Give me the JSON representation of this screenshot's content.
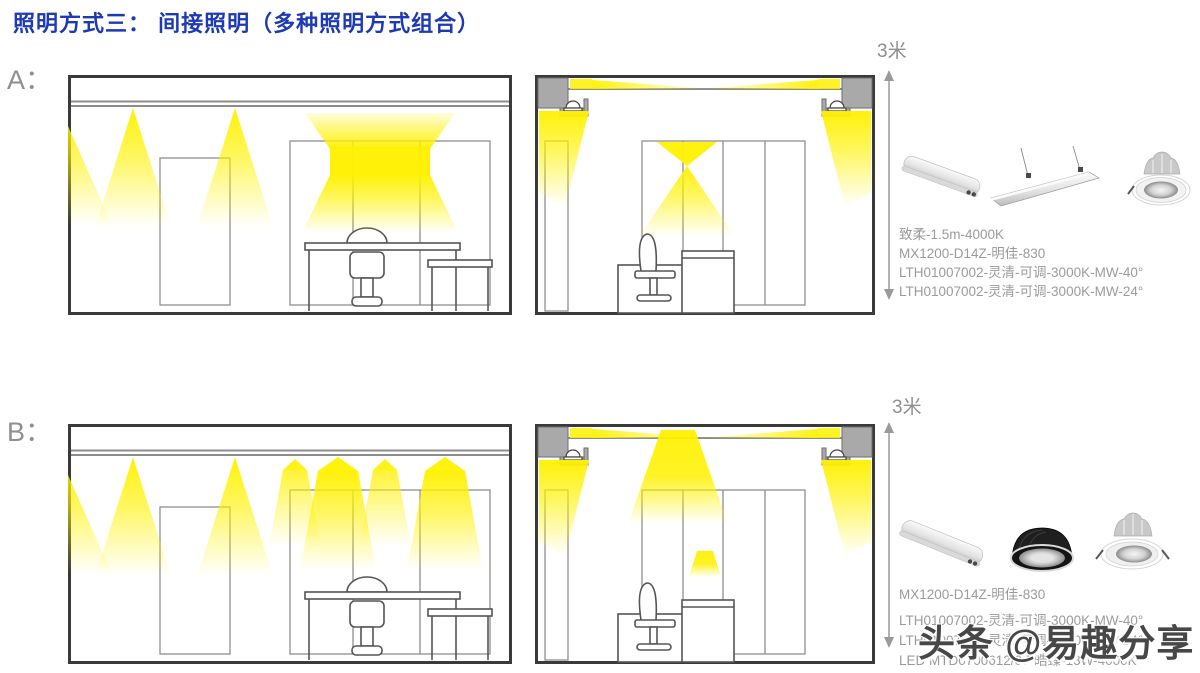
{
  "title": "照明方式三： 间接照明（多种照明方式组合）",
  "watermark": "头条 @易趣分享",
  "colors": {
    "title_blue": "#1D39B5",
    "light_yellow": "#FFF100",
    "ceiling_gray": "#A9A9A9",
    "text_gray": "#9B9B9B"
  },
  "sections": [
    {
      "id": "A",
      "label": "A：",
      "height_label": "3米",
      "product_images": [
        {
          "name": "linear-batten-tube-light"
        },
        {
          "name": "suspended-linear-panel-light"
        },
        {
          "name": "recessed-downlight-white"
        }
      ],
      "product_lines": [
        "致柔-1.5m-4000K",
        "MX1200-D14Z-明佳-830",
        "LTH01007002-灵清-可调-3000K-MW-40°",
        "LTH01007002-灵清-可调-3000K-MW-24°"
      ]
    },
    {
      "id": "B",
      "label": "B：",
      "height_label": "3米",
      "product_images": [
        {
          "name": "linear-batten-tube-light"
        },
        {
          "name": "recessed-downlight-black"
        },
        {
          "name": "recessed-downlight-white"
        }
      ],
      "product_lines": [
        "MX1200-D14Z-明佳-830",
        "LTH01007002-灵清-可调-3000K-MW-40°",
        "LTH01007002-灵清-可调-3000K-MW-24°",
        "LED MTD0700612/07-皓臻-13W-4000K"
      ]
    }
  ]
}
